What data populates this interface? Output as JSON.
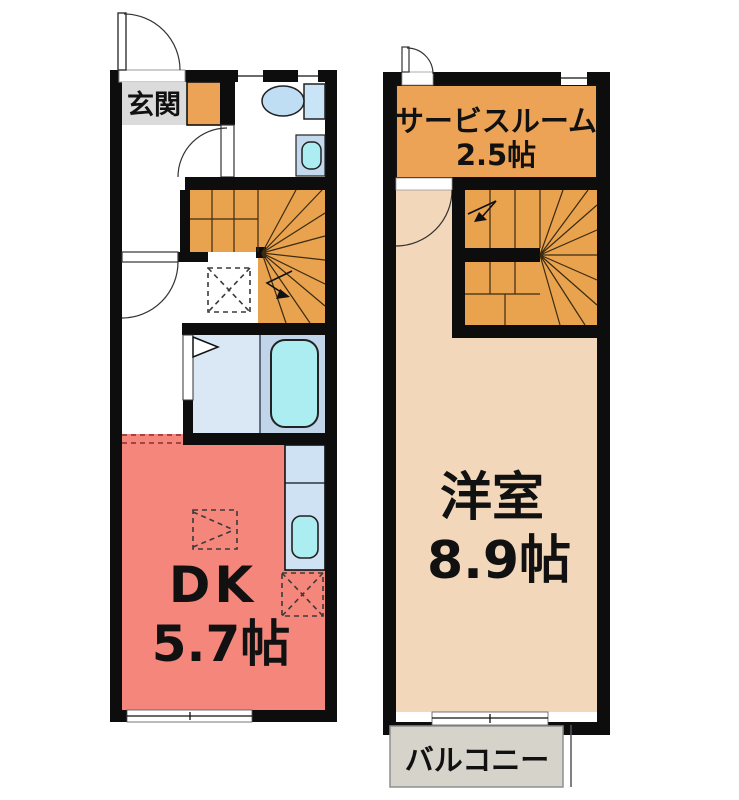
{
  "plan_title": "maisonette floor plan (1F / 2F)",
  "colors": {
    "wall": "#0d0d0d",
    "white": "#ffffff",
    "dk_salmon": "#F5867C",
    "orange": "#EDA356",
    "stair_orange": "#E9A24E",
    "bedroom_beige": "#F3D7BA",
    "entrance_gray": "#DBDBDB",
    "balcony_gray": "#D6D3CA",
    "washroom_blue": "#DAE7F4",
    "bath_blue": "#C0D4EA",
    "toilet_blue": "#BFDDF3",
    "tank_blue": "#C9E3F7",
    "basin_blue": "#C3D9EE",
    "water_cyan": "#ABEDF0",
    "counter_blue": "#CFE2F4"
  },
  "floor1": {
    "entrance": {
      "label": "玄関"
    },
    "dk": {
      "label": "DK",
      "size": "5.7帖"
    }
  },
  "floor2": {
    "service_room": {
      "label": "サービスルーム",
      "size": "2.5帖"
    },
    "bedroom": {
      "label": "洋室",
      "size": "8.9帖"
    },
    "balcony": {
      "label": "バルコニー"
    }
  }
}
